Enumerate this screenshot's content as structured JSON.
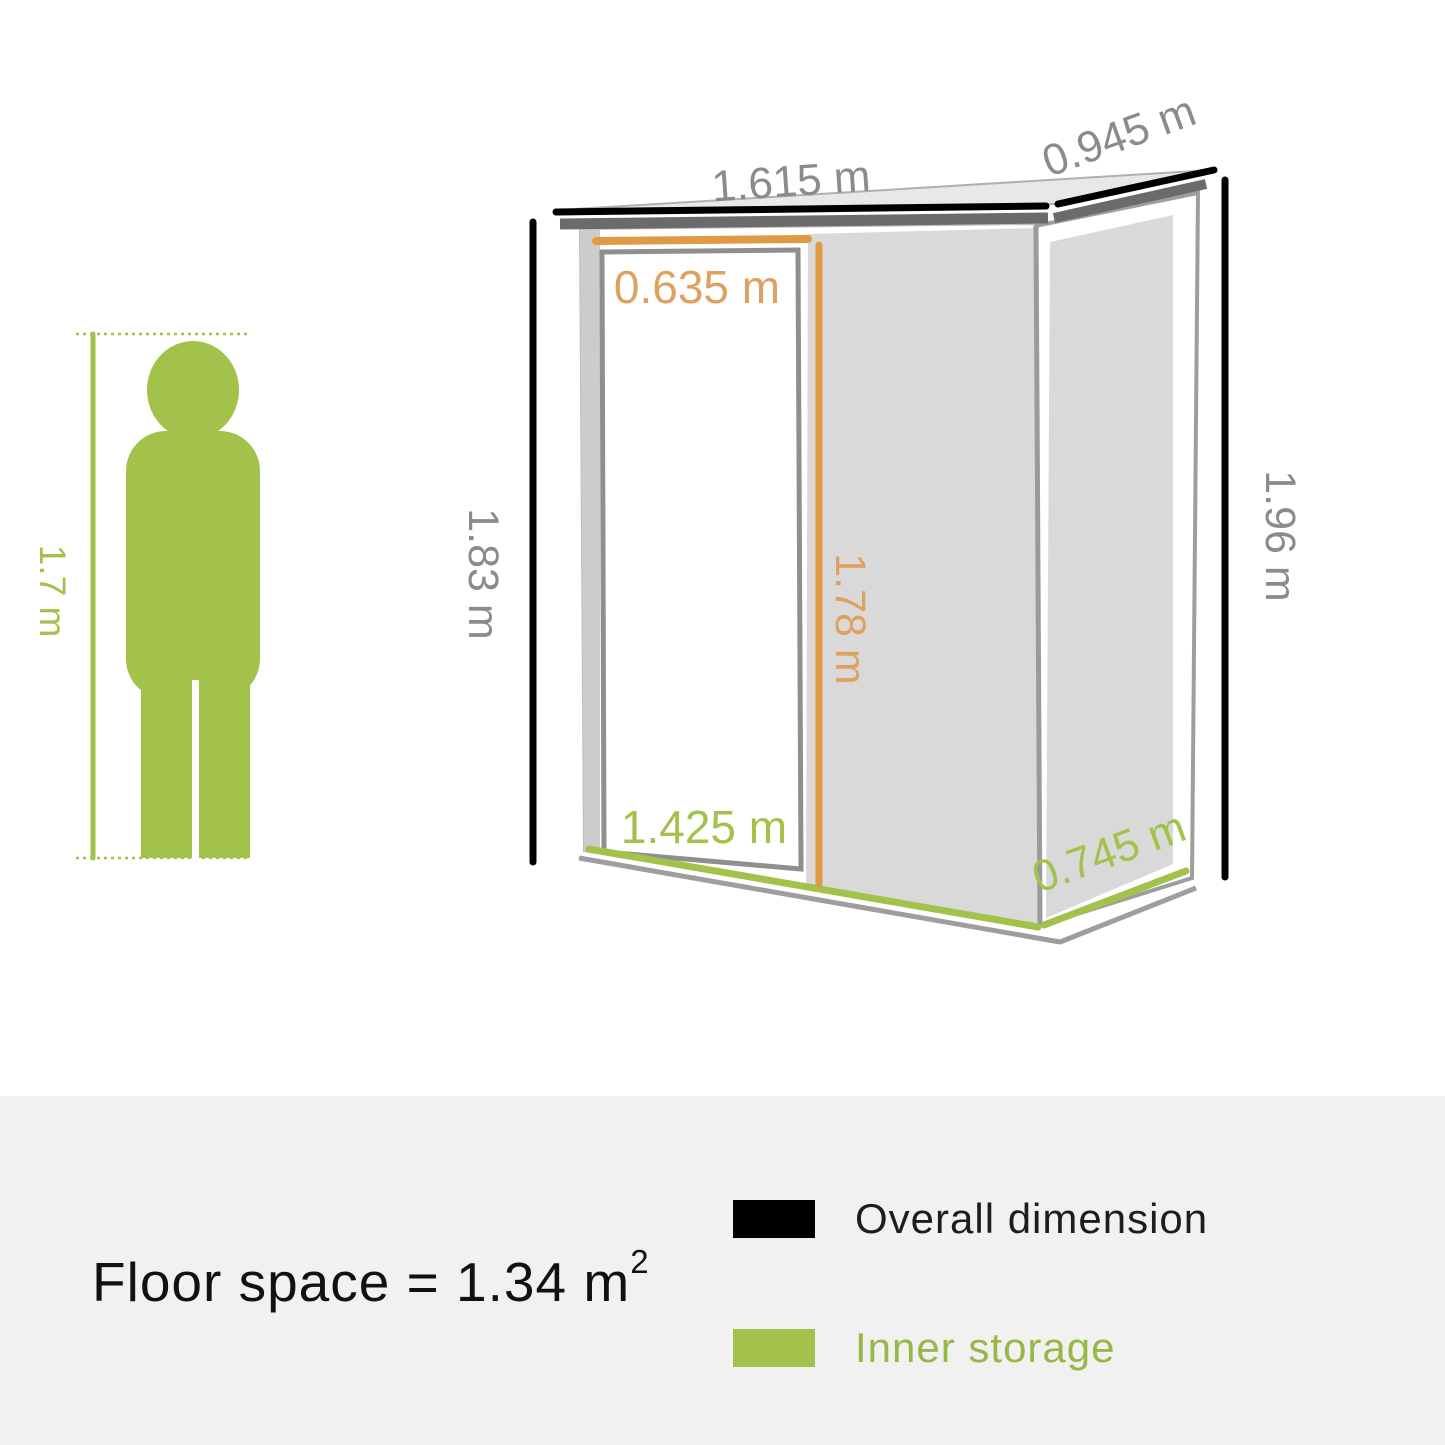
{
  "title": "Garden storage shed dimension diagram",
  "colors": {
    "accent_green": "#a3c24b",
    "accent_orange": "#df9b43",
    "dimension_text_gray": "#8b8b8b",
    "overall_dimension_black": "#000000",
    "wall_panel_gray": "#d9d9d9",
    "background_band": "#f1f1f1"
  },
  "person": {
    "height_label": "1.7 m"
  },
  "shed": {
    "roof_width_label": "1.615 m",
    "roof_depth_label": "0.945 m",
    "door_width_label": "0.635 m",
    "front_height_label": "1.83 m",
    "door_height_label": "1.78 m",
    "back_height_label": "1.96 m",
    "inner_width_label": "1.425 m",
    "inner_depth_label": "0.745 m"
  },
  "floor_space": {
    "text": "Floor space = 1.34 m",
    "superscript": "2"
  },
  "legend": [
    {
      "label": "Overall dimension",
      "color": "#000000"
    },
    {
      "label": "Inner storage",
      "color": "#a3c24b"
    }
  ]
}
